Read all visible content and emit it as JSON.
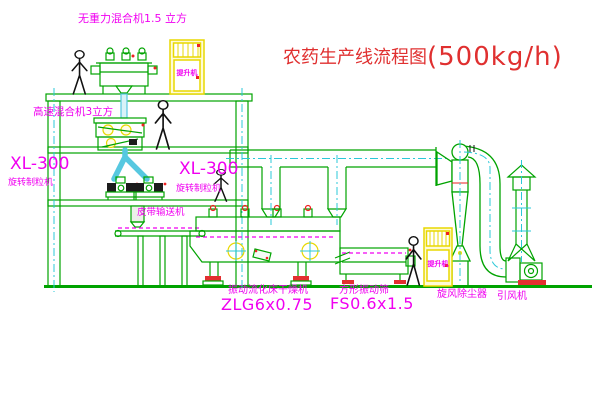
{
  "title": {
    "name": "农药生产线流程图",
    "capacity": "(500kg/h)"
  },
  "equipment_labels": {
    "top_mixer": "无重力混合机1.5 立方",
    "mid_mixer": "高速混合机3立方",
    "granulator_left_model": "XL-300",
    "granulator_left_name": "旋转制粒机",
    "granulator_right_model": "XL-300",
    "granulator_right_name": "旋转制粒机",
    "belt_conveyor": "皮带输送机",
    "dryer_name": "振动流化床干燥机",
    "dryer_model": "ZLG6x0.75",
    "screen_name": "方形振动筛",
    "screen_model": "FS0.6x1.5",
    "cyclone": "旋风除尘器",
    "fan": "引风机",
    "elevator_top": "提升机",
    "elevator_right": "提升机"
  },
  "colors": {
    "line_green": "#00A300",
    "centerline_cyan": "#2BC8D8",
    "label_magenta": "#F000F0",
    "title_red": "#E03030",
    "machine_yellow": "#E8D800",
    "accent_red": "#EE2222",
    "chute_blue": "#57C8E0"
  }
}
